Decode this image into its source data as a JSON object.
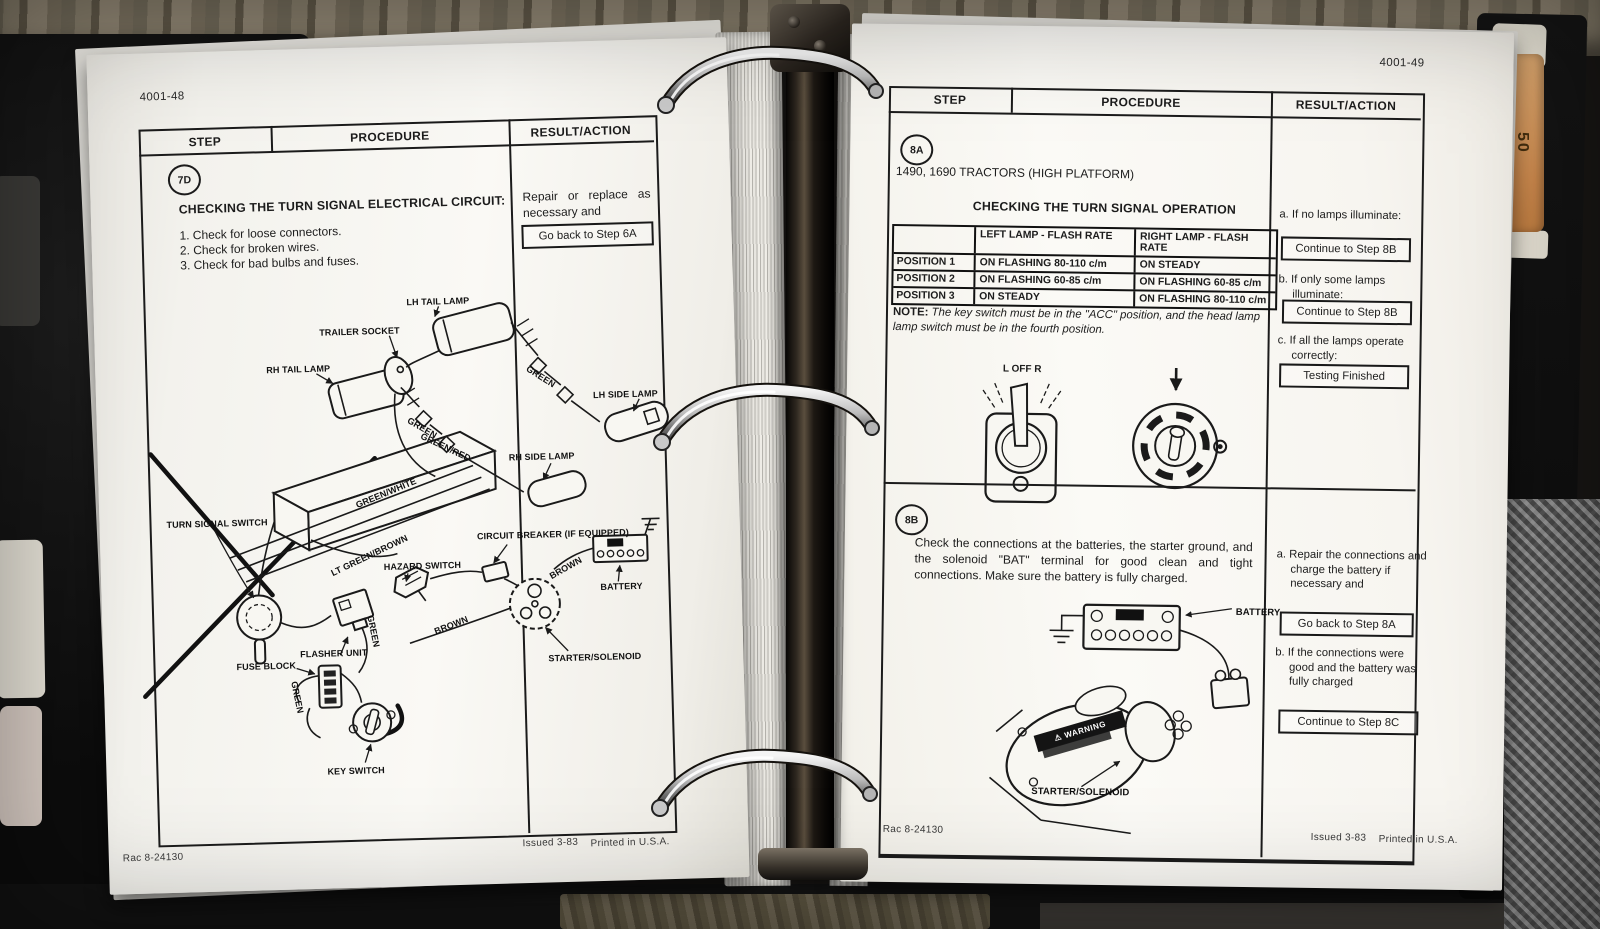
{
  "binder": {
    "tab_number": "50",
    "tab_text": "STEERING"
  },
  "left_page": {
    "page_number": "4001-48",
    "headers": [
      "STEP",
      "PROCEDURE",
      "RESULT/ACTION"
    ],
    "step_badge": "7D",
    "procedure_title": "CHECKING THE TURN SIGNAL ELECTRICAL CIRCUIT:",
    "procedure_items": [
      "1. Check for loose connectors.",
      "2. Check for broken wires.",
      "3. Check for bad bulbs and fuses."
    ],
    "result_text": "Repair or replace as necessary and",
    "result_button": "Go back to Step 6A",
    "diagram_labels": {
      "lh_tail_lamp": "LH TAIL LAMP",
      "trailer_socket": "TRAILER SOCKET",
      "rh_tail_lamp": "RH TAIL LAMP",
      "green_lh": "GREEN",
      "lh_side_lamp": "LH SIDE LAMP",
      "green_rh": "GREEN",
      "green_red": "GREEN/RED",
      "rh_side_lamp": "RH SIDE LAMP",
      "green_white": "GREEN/WHITE",
      "turn_signal_switch": "TURN SIGNAL SWITCH",
      "lt_green_brown": "LT GREEN/BROWN",
      "hazard_switch": "HAZARD SWITCH",
      "circuit_breaker": "CIRCUIT BREAKER (IF EQUIPPED)",
      "brown_upper": "BROWN",
      "battery": "BATTERY",
      "green_flasher": "GREEN",
      "flasher_unit": "FLASHER UNIT",
      "brown_lower": "BROWN",
      "fuse_block": "FUSE BLOCK",
      "green_lower": "GREEN",
      "starter_solenoid": "STARTER/SOLENOID",
      "key_switch": "KEY SWITCH"
    },
    "footer": {
      "code": "Rac 8-24130",
      "issued": "Issued 3-83",
      "printed": "Printed in U.S.A."
    }
  },
  "right_page": {
    "page_number": "4001-49",
    "headers": [
      "STEP",
      "PROCEDURE",
      "RESULT/ACTION"
    ],
    "step_8a": {
      "badge": "8A",
      "subtitle": "1490, 1690 TRACTORS (HIGH PLATFORM)",
      "title": "CHECKING THE TURN SIGNAL OPERATION",
      "flash_table": {
        "col_left": "LEFT LAMP - FLASH RATE",
        "col_right": "RIGHT LAMP - FLASH RATE",
        "rows": [
          [
            "POSITION 1",
            "ON FLASHING 80-110 c/m",
            "ON STEADY"
          ],
          [
            "POSITION 2",
            "ON FLASHING 60-85 c/m",
            "ON FLASHING 60-85 c/m"
          ],
          [
            "POSITION 3",
            "ON STEADY",
            "ON FLASHING 80-110 c/m"
          ]
        ]
      },
      "note_label": "NOTE:",
      "note_text": "The key switch must be in the \"ACC\" position, and the head lamp lamp switch must be in the fourth position.",
      "toggle_label": "L OFF R",
      "results": [
        {
          "label": "a. If no lamps illuminate:",
          "button": "Continue to Step 8B"
        },
        {
          "label": "b. If only some lamps illuminate:",
          "button": "Continue to Step 8B"
        },
        {
          "label": "c. If all the lamps operate correctly:",
          "button": "Testing Finished"
        }
      ]
    },
    "step_8b": {
      "badge": "8B",
      "procedure_text": "Check the connections at the batteries, the starter ground, and the solenoid \"BAT\" terminal for good clean and tight connections. Make sure the battery is fully charged.",
      "battery_label": "BATTERY",
      "warning_label": "⚠ WARNING",
      "starter_label": "STARTER/SOLENOID",
      "results": [
        {
          "label": "a. Repair the connections and charge the battery if necessary and",
          "button": "Go back to Step 8A"
        },
        {
          "label": "b. If the connections were good and the battery was fully charged",
          "button": "Continue to Step 8C"
        }
      ]
    },
    "footer": {
      "code": "Rac 8-24130",
      "issued": "Issued 3-83",
      "printed": "Printed in U.S.A."
    }
  }
}
